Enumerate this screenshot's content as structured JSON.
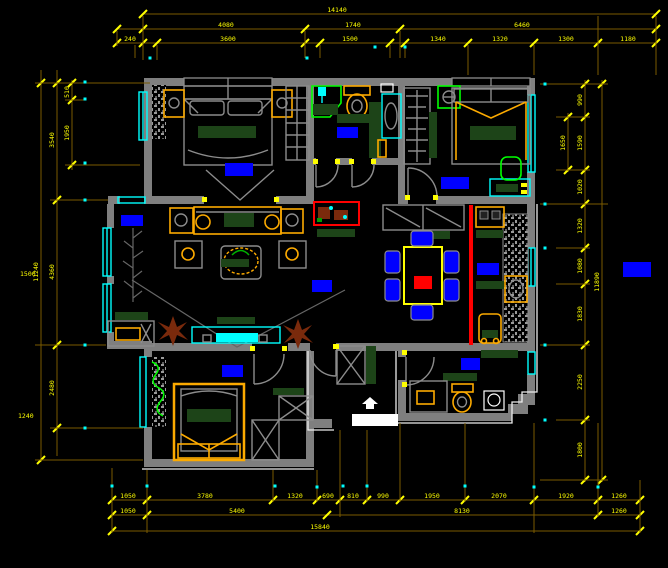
{
  "meta": {
    "drawing_type": "apartment floor plan (CAD)",
    "colors": {
      "background": "#000000",
      "wall": "#7f7f7f",
      "window": "#00ffff",
      "dim_line": "#7a5a00",
      "dim_text": "#ffff00",
      "room_label": "#0000ff",
      "furniture_line": "#8c8c8c",
      "furniture_accent": "#fcaa00",
      "dark_green": "#1d4418",
      "bright_green": "#00ff00",
      "red_accent": "#ff0000",
      "plant_brown": "#7a2a0c",
      "white": "#ffffff"
    }
  },
  "room_labels": [
    {
      "name": "master-bedroom",
      "x": 225,
      "y": 163,
      "w": 28,
      "h": 13
    },
    {
      "name": "bathroom",
      "x": 337,
      "y": 127,
      "w": 21,
      "h": 11
    },
    {
      "name": "bedroom-2",
      "x": 441,
      "y": 177,
      "w": 28,
      "h": 12
    },
    {
      "name": "bay-window",
      "x": 121,
      "y": 215,
      "w": 22,
      "h": 11
    },
    {
      "name": "living-room",
      "x": 312,
      "y": 280,
      "w": 20,
      "h": 12
    },
    {
      "name": "kitchen",
      "x": 477,
      "y": 263,
      "w": 22,
      "h": 12
    },
    {
      "name": "bedroom-3",
      "x": 222,
      "y": 365,
      "w": 21,
      "h": 12
    },
    {
      "name": "bathroom-2",
      "x": 461,
      "y": 358,
      "w": 19,
      "h": 12
    },
    {
      "name": "side-note",
      "x": 623,
      "y": 262,
      "w": 28,
      "h": 15
    }
  ],
  "dimensions": {
    "chains": [
      {
        "dir": "h",
        "pos": 14,
        "from": 143,
        "to": 656,
        "ticks": [
          143,
          656
        ],
        "labels": [
          {
            "at": 337,
            "text": "14140"
          }
        ]
      },
      {
        "dir": "h",
        "pos": 29,
        "from": 117,
        "to": 656,
        "ticks": [
          117,
          143,
          305,
          400,
          656
        ],
        "labels": [
          {
            "at": 226,
            "text": "4080"
          },
          {
            "at": 353,
            "text": "1740"
          },
          {
            "at": 522,
            "text": "6460"
          }
        ]
      },
      {
        "dir": "h",
        "pos": 43,
        "from": 117,
        "to": 656,
        "ticks": [
          117,
          143,
          157,
          305,
          320,
          390,
          405,
          468,
          534,
          598,
          656
        ],
        "labels": [
          {
            "at": 130,
            "text": "240"
          },
          {
            "at": 228,
            "text": "3600"
          },
          {
            "at": 350,
            "text": "1500"
          },
          {
            "at": 438,
            "text": "1340"
          },
          {
            "at": 500,
            "text": "1320"
          },
          {
            "at": 566,
            "text": "1300"
          },
          {
            "at": 628,
            "text": "1180"
          }
        ]
      },
      {
        "dir": "v",
        "pos": 41,
        "from": 70,
        "to": 462,
        "ticks": [
          83,
          460
        ],
        "labels": [
          {
            "at": 272,
            "text": "11240"
          }
        ]
      },
      {
        "dir": "v",
        "pos": 57,
        "from": 70,
        "to": 456,
        "ticks": [
          83,
          200,
          345,
          428
        ],
        "labels": [
          {
            "at": 140,
            "text": "3540"
          },
          {
            "at": 272,
            "text": "4360"
          },
          {
            "at": 388,
            "text": "2480"
          }
        ]
      },
      {
        "dir": "v",
        "pos": 72,
        "from": 80,
        "to": 170,
        "ticks": [
          83,
          100,
          165
        ],
        "labels": [
          {
            "at": 92,
            "text": "510"
          },
          {
            "at": 133,
            "text": "1950"
          }
        ]
      },
      {
        "dir": "v",
        "pos": 568,
        "from": 113,
        "to": 172,
        "ticks": [
          117,
          170
        ],
        "labels": [
          {
            "at": 143,
            "text": "1650"
          }
        ]
      },
      {
        "dir": "v",
        "pos": 585,
        "from": 80,
        "to": 482,
        "ticks": [
          84,
          117,
          170,
          204,
          248,
          284,
          345,
          420,
          480
        ],
        "labels": [
          {
            "at": 100,
            "text": "990"
          },
          {
            "at": 143,
            "text": "1590"
          },
          {
            "at": 187,
            "text": "1020"
          },
          {
            "at": 226,
            "text": "1320"
          },
          {
            "at": 266,
            "text": "1080"
          },
          {
            "at": 314,
            "text": "1830"
          },
          {
            "at": 382,
            "text": "2250"
          },
          {
            "at": 450,
            "text": "1800"
          }
        ]
      },
      {
        "dir": "v",
        "pos": 602,
        "from": 80,
        "to": 482,
        "ticks": [
          84,
          480
        ],
        "labels": [
          {
            "at": 282,
            "text": "11890"
          }
        ]
      },
      {
        "dir": "h",
        "pos": 500,
        "from": 112,
        "to": 640,
        "ticks": [
          112,
          147,
          273,
          317,
          340,
          367,
          400,
          465,
          534,
          598,
          640
        ],
        "labels": [
          {
            "at": 128,
            "text": "1050"
          },
          {
            "at": 205,
            "text": "3780"
          },
          {
            "at": 295,
            "text": "1320"
          },
          {
            "at": 328,
            "text": "690"
          },
          {
            "at": 353,
            "text": "810"
          },
          {
            "at": 383,
            "text": "990"
          },
          {
            "at": 432,
            "text": "1950"
          },
          {
            "at": 499,
            "text": "2070"
          },
          {
            "at": 566,
            "text": "1920"
          },
          {
            "at": 619,
            "text": "1260"
          }
        ]
      },
      {
        "dir": "h",
        "pos": 515,
        "from": 112,
        "to": 640,
        "ticks": [
          112,
          147,
          327,
          598,
          640
        ],
        "labels": [
          {
            "at": 128,
            "text": "1050"
          },
          {
            "at": 237,
            "text": "5400"
          },
          {
            "at": 462,
            "text": "8130"
          },
          {
            "at": 619,
            "text": "1260"
          }
        ]
      },
      {
        "dir": "h",
        "pos": 531,
        "from": 112,
        "to": 640,
        "ticks": [
          112,
          640
        ],
        "labels": [
          {
            "at": 320,
            "text": "15840"
          }
        ]
      }
    ],
    "extensions": [
      [
        143,
        16,
        143,
        60
      ],
      [
        305,
        31,
        305,
        58
      ],
      [
        400,
        31,
        400,
        58
      ],
      [
        390,
        45,
        390,
        58
      ],
      [
        405,
        45,
        405,
        58
      ],
      [
        468,
        45,
        468,
        75
      ],
      [
        534,
        45,
        534,
        75
      ],
      [
        598,
        16,
        598,
        75
      ],
      [
        656,
        16,
        656,
        75
      ],
      [
        117,
        31,
        117,
        46
      ],
      [
        135,
        45,
        135,
        58
      ],
      [
        157,
        45,
        157,
        60
      ],
      [
        320,
        45,
        320,
        58
      ],
      [
        35,
        83,
        150,
        83
      ],
      [
        65,
        100,
        85,
        100
      ],
      [
        65,
        165,
        140,
        165
      ],
      [
        50,
        200,
        108,
        200
      ],
      [
        35,
        345,
        106,
        345
      ],
      [
        50,
        428,
        143,
        428
      ],
      [
        35,
        460,
        143,
        460
      ],
      [
        540,
        84,
        608,
        84
      ],
      [
        556,
        117,
        590,
        117
      ],
      [
        556,
        170,
        590,
        170
      ],
      [
        540,
        204,
        608,
        204
      ],
      [
        556,
        248,
        590,
        248
      ],
      [
        556,
        284,
        590,
        284
      ],
      [
        540,
        345,
        590,
        345
      ],
      [
        556,
        420,
        590,
        420
      ],
      [
        540,
        480,
        608,
        480
      ],
      [
        112,
        468,
        112,
        533
      ],
      [
        147,
        470,
        147,
        533
      ],
      [
        273,
        470,
        273,
        502
      ],
      [
        317,
        470,
        317,
        502
      ],
      [
        340,
        430,
        340,
        517
      ],
      [
        367,
        430,
        367,
        502
      ],
      [
        400,
        423,
        400,
        502
      ],
      [
        465,
        423,
        465,
        502
      ],
      [
        534,
        423,
        534,
        533
      ],
      [
        598,
        423,
        598,
        517
      ],
      [
        640,
        480,
        640,
        533
      ]
    ],
    "dots": [
      [
        85,
        82
      ],
      [
        85,
        99
      ],
      [
        85,
        163
      ],
      [
        85,
        200
      ],
      [
        85,
        345
      ],
      [
        85,
        428
      ],
      [
        150,
        58
      ],
      [
        307,
        58
      ],
      [
        375,
        47
      ],
      [
        405,
        47
      ],
      [
        545,
        84
      ],
      [
        545,
        204
      ],
      [
        545,
        248
      ],
      [
        545,
        345
      ],
      [
        545,
        420
      ],
      [
        112,
        486
      ],
      [
        147,
        486
      ],
      [
        275,
        486
      ],
      [
        317,
        487
      ],
      [
        343,
        486
      ],
      [
        367,
        486
      ],
      [
        465,
        486
      ],
      [
        534,
        487
      ],
      [
        598,
        487
      ]
    ],
    "margin_texts": [
      {
        "x": 20,
        "y": 276,
        "text": "1500"
      },
      {
        "x": 18,
        "y": 418,
        "text": "1240"
      }
    ]
  }
}
